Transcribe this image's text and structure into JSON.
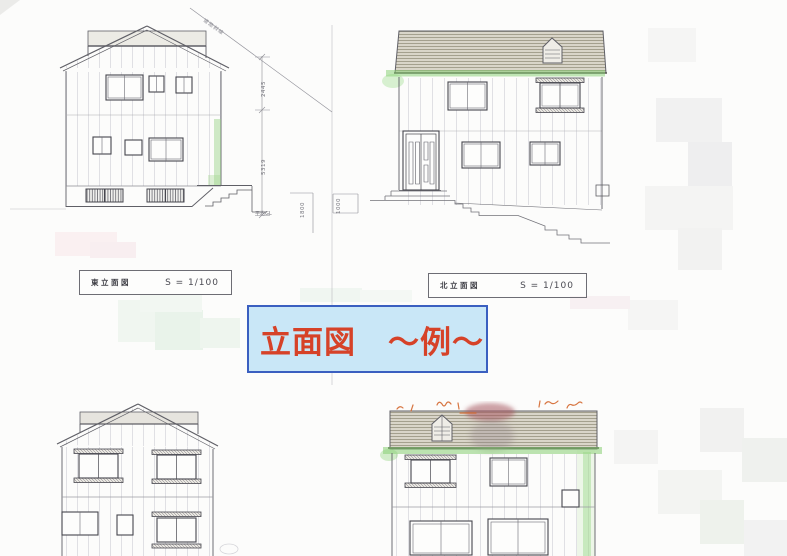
{
  "page": {
    "background": "#fcfcfb",
    "type": "scanned-elevation-drawings"
  },
  "banner": {
    "text": "立面図　～例～",
    "bg": "#c9e7f7",
    "border": "#3a5fc0",
    "color": "#d64228"
  },
  "labels": {
    "east": {
      "title": "東立面図",
      "scale": "S = 1/100"
    },
    "north": {
      "title": "北立面図",
      "scale": "S = 1/100"
    }
  },
  "dimensions": {
    "upper": "2445",
    "lower": "5319",
    "ground_drop": "1800",
    "retaining": "1000",
    "gl": "平均GL"
  },
  "notes": {
    "setback_line": "道路斜線"
  },
  "colors": {
    "pencil": "#5f5f66",
    "marker_green": "#8fd37a",
    "annotation_orange": "#d4682f",
    "redaction_pink": "#a5555f"
  }
}
